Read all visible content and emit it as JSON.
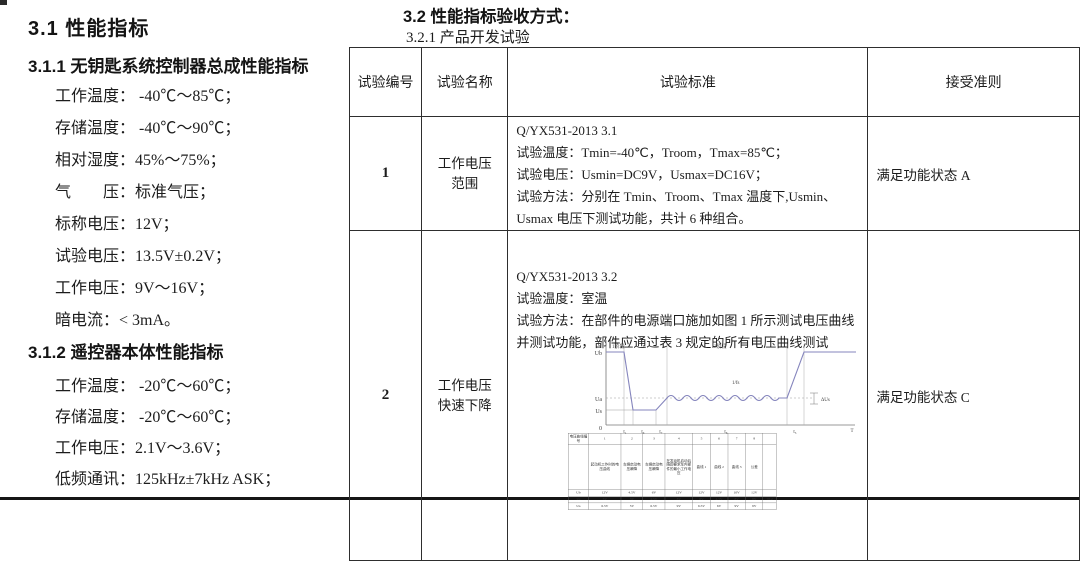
{
  "left": {
    "h1": "3.1 性能指标",
    "h2a": "3.1.1 无钥匙系统控制器总成性能指标",
    "spec1": [
      "工作温度：  -40℃～85℃；",
      "存储温度：  -40℃～90℃；",
      "相对湿度：45%～75%；",
      "气　　压：标准气压；",
      "标称电压：12V；",
      "试验电压：13.5V±0.2V；",
      "工作电压：9V～16V；",
      "暗电流：< 3mA。"
    ],
    "h2b": "3.1.2 遥控器本体性能指标",
    "spec2": [
      "工作温度：  -20℃～60℃；",
      "存储温度：  -20℃～60℃；",
      "工作电压：2.1V～3.6V；",
      "低频通讯：125kHz±7kHz ASK；"
    ]
  },
  "right": {
    "h1": "3.2 性能指标验收方式：",
    "h2": "3.2.1 产品开发试验",
    "table": {
      "headers": [
        "试验编号",
        "试验名称",
        "试验标准",
        "接受准则"
      ],
      "rows": [
        {
          "no": "1",
          "name": "工作电压范围",
          "standard_lines": [
            "Q/YX531-2013 3.1",
            "试验温度：Tmin=-40℃，Troom，Tmax=85℃；",
            "试验电压：Usmin=DC9V，Usmax=DC16V；",
            "试验方法：分别在 Tmin、Troom、Tmax 温度下,Usmin、Usmax 电压下测试功能，共计 6 种组合。"
          ],
          "accept": "满足功能状态 A"
        },
        {
          "no": "2",
          "name": "工作电压快速下降",
          "standard_lines": [
            "Q/YX531-2013 3.2",
            "试验温度：室温",
            "试验方法：在部件的电源端口施加如图 1 所示测试电压曲线并测试功能，部件应通过表 3 规定的所有电压曲线测试"
          ],
          "accept": "满足功能状态 C",
          "figure": {
            "axis_y": "U",
            "axis_x_end": "T",
            "origin": "0",
            "level_top": "Ub",
            "level_mid": "Ua",
            "level_low": "Us",
            "phase_1": "1阶段",
            "phase_2": "2阶段",
            "ripple_label": "1/fs",
            "delta_label": "ΔUs",
            "ticks": [
              "t₁",
              "t₆",
              "t₇",
              "t₈",
              "t₅"
            ]
          },
          "curve_table": {
            "rows": [
              [
                "电压曲线编号",
                "1",
                "2",
                "3",
                "4",
                "5",
                "6",
                "7",
                "8",
                ""
              ],
              [
                "",
                "起动机工作时的电压曲线",
                "车辆启动电压瞬降",
                "车辆启动电压瞬降",
                "在发动机启动后随即要求车内部件的最小工作电压",
                "曲线 1",
                "曲线 2",
                "曲线 3",
                "公差",
                ""
              ],
              [
                "Ub",
                "12V",
                "4.5V",
                "6V",
                "12V",
                "12V",
                "12V",
                "10V",
                "12V",
                ""
              ],
              [
                "Us",
                "5V",
                "3V",
                "4.5V",
                "8V",
                "6V",
                "4.5V",
                "8V",
                "8V",
                "±0.2"
              ],
              [
                "Ua",
                "6.5V",
                "5V",
                "6.5V",
                "9V",
                "6.5V",
                "6V",
                "9V",
                "9V",
                ""
              ]
            ]
          }
        }
      ]
    }
  }
}
